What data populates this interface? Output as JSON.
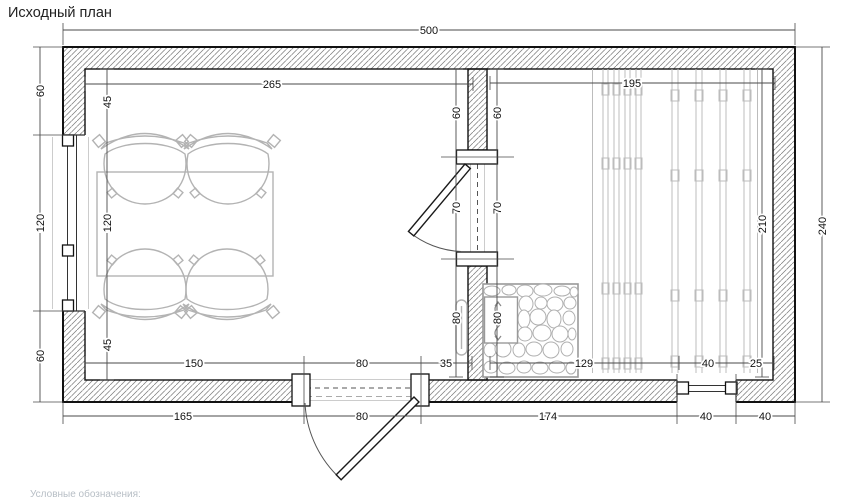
{
  "title": "Исходный план",
  "legend_caption": "Условные обозначения:",
  "colors": {
    "wall_line": "#111111",
    "hatch": "#7a7a7a",
    "furniture": "#b3b3b3",
    "dimension_line": "#4a4a4a",
    "legend_text": "#b7bec5",
    "background": "#ffffff"
  },
  "dimensions": {
    "top_total": "500",
    "left_room_top": "265",
    "right_room_top": "195",
    "left_outer": [
      "60",
      "120",
      "60"
    ],
    "left_inner": [
      "45",
      "120",
      "45"
    ],
    "partition_left": [
      "60",
      "70",
      "80"
    ],
    "partition_right": [
      "60",
      "70",
      "80"
    ],
    "right_inner": "210",
    "right_outer": "240",
    "bottom_inner_left": [
      "150",
      "80",
      "35"
    ],
    "bottom_inner_right": [
      "129",
      "40",
      "25"
    ],
    "bottom_outer": [
      "165",
      "80",
      "174",
      "40",
      "40"
    ]
  }
}
